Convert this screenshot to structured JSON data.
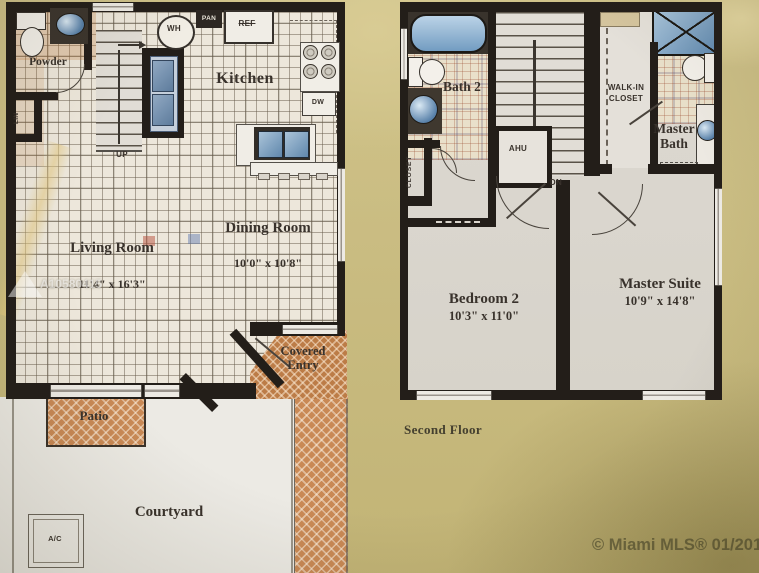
{
  "colors": {
    "background_khaki": "#c9bb79",
    "wall": "#241f1a",
    "tile_floor": "#ece6d9",
    "terracotta_hatch": "#cd8850",
    "fixture_blue": "#5580ac",
    "label_text": "#3a332c"
  },
  "first_floor": {
    "labels": {
      "powder": "Powder",
      "linen": "LIN",
      "water_heater": "WH",
      "pantry": "PAN",
      "refrigerator": "REF",
      "kitchen": "Kitchen",
      "dishwasher": "DW",
      "stairs_up": "UP",
      "living_room_name": "Living Room",
      "living_room_dims": "11'4\" x 16'3\"",
      "dining_room_name": "Dining Room",
      "dining_room_dims": "10'0\" x 10'8\"",
      "covered_entry": "Covered Entry",
      "patio": "Patio",
      "courtyard": "Courtyard",
      "ac": "A/C"
    }
  },
  "second_floor": {
    "labels": {
      "bath2": "Bath 2",
      "ahu": "AHU",
      "stairs_dn": "DN",
      "walk_in_closet": "WALK-IN CLOSET",
      "closet": "CLOSET",
      "master_bath": "Master Bath",
      "bedroom2_name": "Bedroom 2",
      "bedroom2_dims": "10'3\" x 11'0\"",
      "master_suite_name": "Master Suite",
      "master_suite_dims": "10'9\" x 14'8\""
    },
    "caption": "Second Floor"
  },
  "watermarks": {
    "listing_id": "A10580415",
    "mls": "© Miami MLS® 01/2019"
  }
}
